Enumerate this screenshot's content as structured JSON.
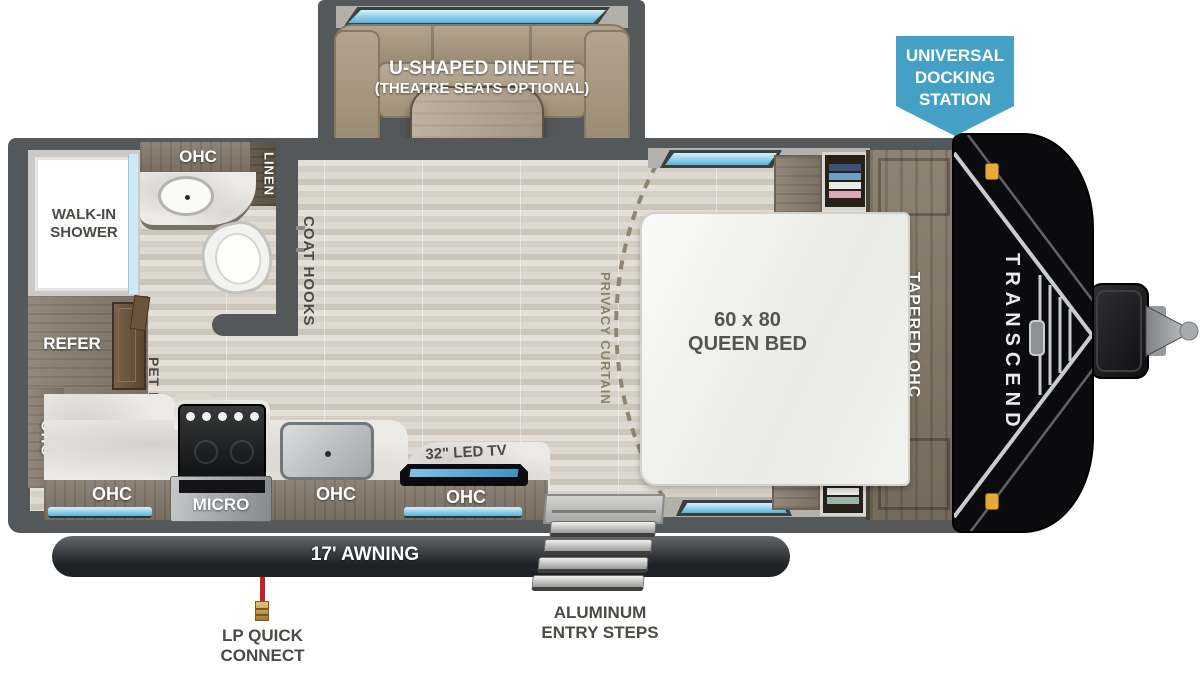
{
  "title": "Transcend travel trailer floor plan",
  "badge": {
    "line1": "UNIVERSAL",
    "line2": "DOCKING",
    "line3": "STATION"
  },
  "dinette": {
    "line1": "U-SHAPED DINETTE",
    "line2": "(THEATRE SEATS OPTIONAL)"
  },
  "bathroom": {
    "shower_line1": "WALK-IN",
    "shower_line2": "SHOWER",
    "ohc": "OHC",
    "linen": "LINEN",
    "coat_hooks": "COAT HOOKS"
  },
  "kitchen": {
    "refer": "REFER",
    "pet_drawer": "PET DRAWER",
    "ohc_left": "OHC",
    "ohc_bottom_left": "OHC",
    "micro": "MICRO",
    "ohc_bottom_center": "OHC",
    "tv": "32\" LED TV",
    "ohc_under_tv": "OHC"
  },
  "bedroom": {
    "privacy_curtain": "PRIVACY CURTAIN",
    "bed_line1": "60 x 80",
    "bed_line2": "QUEEN BED",
    "tapered_ohc": "TAPERED OHC"
  },
  "exterior": {
    "awning": "17' AWNING",
    "steps_line1": "ALUMINUM",
    "steps_line2": "ENTRY STEPS",
    "lp_line1": "LP QUICK",
    "lp_line2": "CONNECT",
    "brand": "TRANSCEND"
  },
  "colors": {
    "badge_blue": "#45a0c5",
    "window_blue": "#58b3da",
    "wall_gray": "#55585b",
    "awning_dark": "#24272a",
    "lp_red": "#c32127",
    "brass": "#c9a45a",
    "wood": "#8f8478",
    "marble": "#eceae4",
    "front_cap_black": "#0b0b0d",
    "marker_amber": "#e8a93c"
  }
}
